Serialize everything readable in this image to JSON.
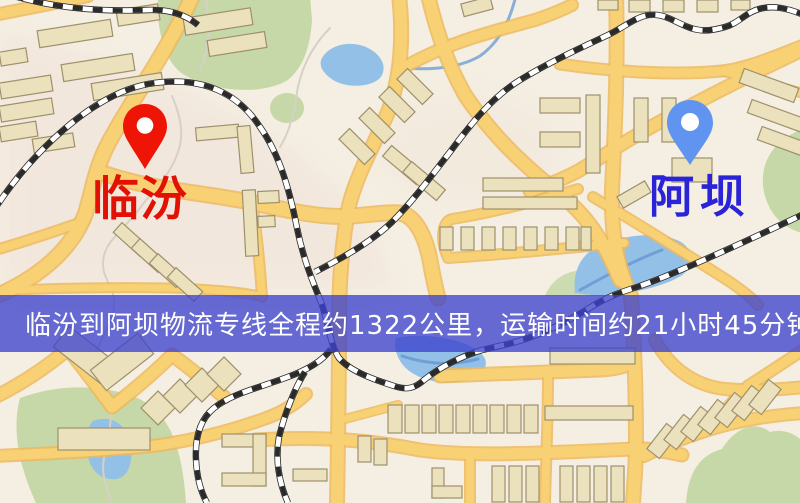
{
  "map": {
    "origin": {
      "label": "临汾"
    },
    "destination": {
      "label": "阿坝"
    },
    "banner": {
      "text": "临汾到阿坝物流专线全程约1322公里，运输时间约21小时45分钟."
    },
    "route": {
      "distance": "约1322公里",
      "duration": "约21小时45分钟"
    }
  },
  "icons": {
    "origin_pin": "map-pin-icon",
    "destination_pin": "map-pin-icon"
  },
  "colors": {
    "map-bg": "#f4efe2",
    "tint-pink": "#f1ddd6",
    "road-fill": "#f7d173",
    "road-casing": "#edb85e",
    "water": "#92c0e6",
    "water-line": "#6f9fd4",
    "park": "#c6d8a7",
    "contour": "#d5d1c5",
    "building-fill": "#ece1bd",
    "building-stroke": "#9e906c",
    "rail-dark": "#2a2a2a",
    "rail-light": "#ffffff",
    "origin-pin": "#ee1506",
    "origin-label": "#e31104",
    "destination-pin": "#6094f0",
    "destination-label": "#2a23d8",
    "banner-bg": "rgba(62,66,205,0.78)",
    "banner-text": "#ffffff"
  }
}
